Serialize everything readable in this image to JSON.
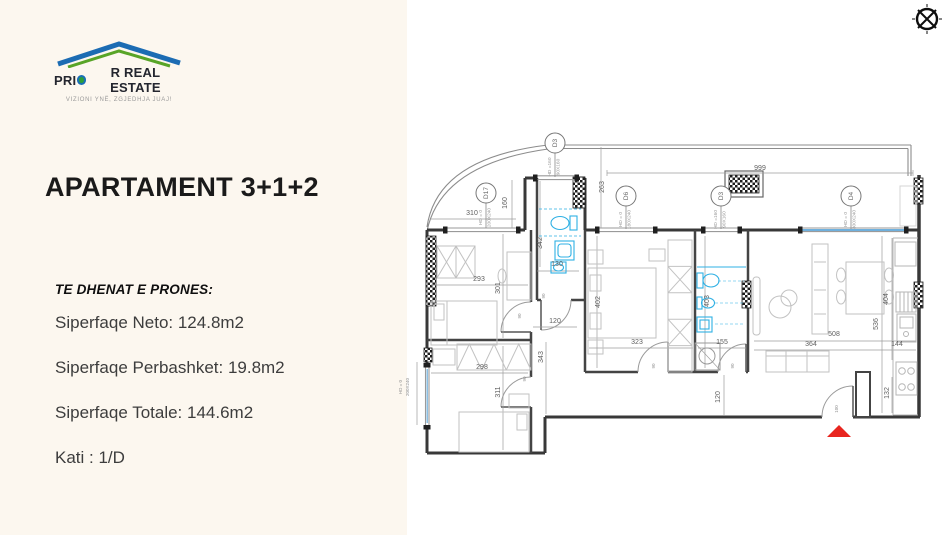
{
  "panel": {
    "bg": "#fcf7ef"
  },
  "logo": {
    "name_pre": "PRI",
    "name_post": "R REAL ESTATE",
    "tagline": "VIZIONI YNË, ZGJEDHJA JUAJ!",
    "roof_blue": "#1c6cb3",
    "roof_green": "#58a427"
  },
  "listing": {
    "title": "APARTAMENT 3+1+2",
    "details_heading": "TE DHENAT E PRONES:",
    "details": [
      "Siperfaqe Neto: 124.8m2",
      "Siperfaqe Perbashket: 19.8m2",
      "Siperfaqe Totale: 144.6m2",
      "Kati : 1/D"
    ]
  },
  "floorplan": {
    "wall_color": "#383838",
    "fixture_color": "#2fb0e4",
    "glazing_color": "#6fb0dd",
    "entrance_marker_color": "#e8251f",
    "dim_labels": [
      {
        "t": "999",
        "x": 760,
        "y": 170
      },
      {
        "t": "263",
        "x": 604,
        "y": 187,
        "r": 1
      },
      {
        "t": "310",
        "x": 472,
        "y": 215
      },
      {
        "t": "160",
        "x": 507,
        "y": 203,
        "r": 1
      },
      {
        "t": "342",
        "x": 542,
        "y": 243,
        "r": 1
      },
      {
        "t": "130",
        "x": 557,
        "y": 266
      },
      {
        "t": "293",
        "x": 479,
        "y": 281
      },
      {
        "t": "301",
        "x": 500,
        "y": 288,
        "r": 1
      },
      {
        "t": "120",
        "x": 555,
        "y": 323
      },
      {
        "t": "298",
        "x": 482,
        "y": 369
      },
      {
        "t": "311",
        "x": 500,
        "y": 392,
        "r": 1
      },
      {
        "t": "343",
        "x": 543,
        "y": 357,
        "r": 1
      },
      {
        "t": "402",
        "x": 600,
        "y": 302,
        "r": 1
      },
      {
        "t": "323",
        "x": 637,
        "y": 344
      },
      {
        "t": "403",
        "x": 709,
        "y": 301,
        "r": 1
      },
      {
        "t": "155",
        "x": 722,
        "y": 344
      },
      {
        "t": "508",
        "x": 834,
        "y": 336
      },
      {
        "t": "364",
        "x": 811,
        "y": 346
      },
      {
        "t": "144",
        "x": 897,
        "y": 346
      },
      {
        "t": "536",
        "x": 878,
        "y": 324,
        "r": 1
      },
      {
        "t": "404",
        "x": 888,
        "y": 299,
        "r": 1
      },
      {
        "t": "132",
        "x": 889,
        "y": 393,
        "r": 1
      },
      {
        "t": "120",
        "x": 720,
        "y": 397,
        "r": 1
      }
    ],
    "tiny_labels": [
      {
        "t": "90",
        "x": 521,
        "y": 316,
        "r": 1
      },
      {
        "t": "90",
        "x": 545,
        "y": 296,
        "r": 1
      },
      {
        "t": "90",
        "x": 526,
        "y": 379,
        "r": 1
      },
      {
        "t": "90",
        "x": 655,
        "y": 366,
        "r": 1
      },
      {
        "t": "90",
        "x": 734,
        "y": 366,
        "r": 1
      },
      {
        "t": "100",
        "x": 838,
        "y": 409,
        "r": 1
      },
      {
        "t": "HD = 0",
        "x": 402,
        "y": 387,
        "r": 1
      },
      {
        "t": "200X240",
        "x": 409,
        "y": 387,
        "r": 1
      }
    ],
    "door_markers": [
      {
        "label": "D17",
        "spec1": "HD = 0",
        "spec2": "200X240",
        "cx": 486,
        "cy": 193,
        "wy": 228
      },
      {
        "label": "D3",
        "spec1": "HD =160",
        "spec2": "90X160",
        "cx": 555,
        "cy": 143,
        "wy": 177
      },
      {
        "label": "D6",
        "spec1": "HD = 0",
        "spec2": "180X240",
        "cx": 626,
        "cy": 196,
        "wy": 229
      },
      {
        "label": "D3",
        "spec1": "HD =160",
        "spec2": "90X160",
        "cx": 721,
        "cy": 196,
        "wy": 229
      },
      {
        "label": "D4",
        "spec1": "HD = 0",
        "spec2": "300X240",
        "cx": 851,
        "cy": 196,
        "wy": 229
      }
    ]
  }
}
